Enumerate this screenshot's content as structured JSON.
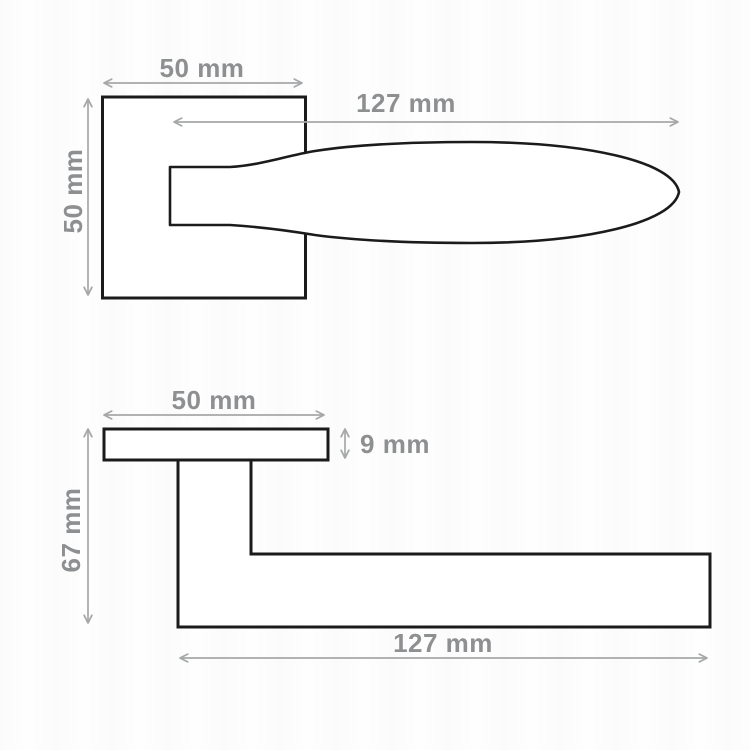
{
  "diagram": {
    "title": "door-handle-dimension-drawing",
    "colors": {
      "outline": "#1b1b1b",
      "dimension": "#a5a7a9",
      "label": "#8d8f91",
      "background": "#fefefe"
    },
    "front_view": {
      "width_label": "50 mm",
      "height_label": "50 mm",
      "length_label": "127 mm"
    },
    "side_view": {
      "width_label": "50 mm",
      "thickness_label": "9 mm",
      "height_label": "67 mm",
      "length_label": "127 mm"
    }
  }
}
